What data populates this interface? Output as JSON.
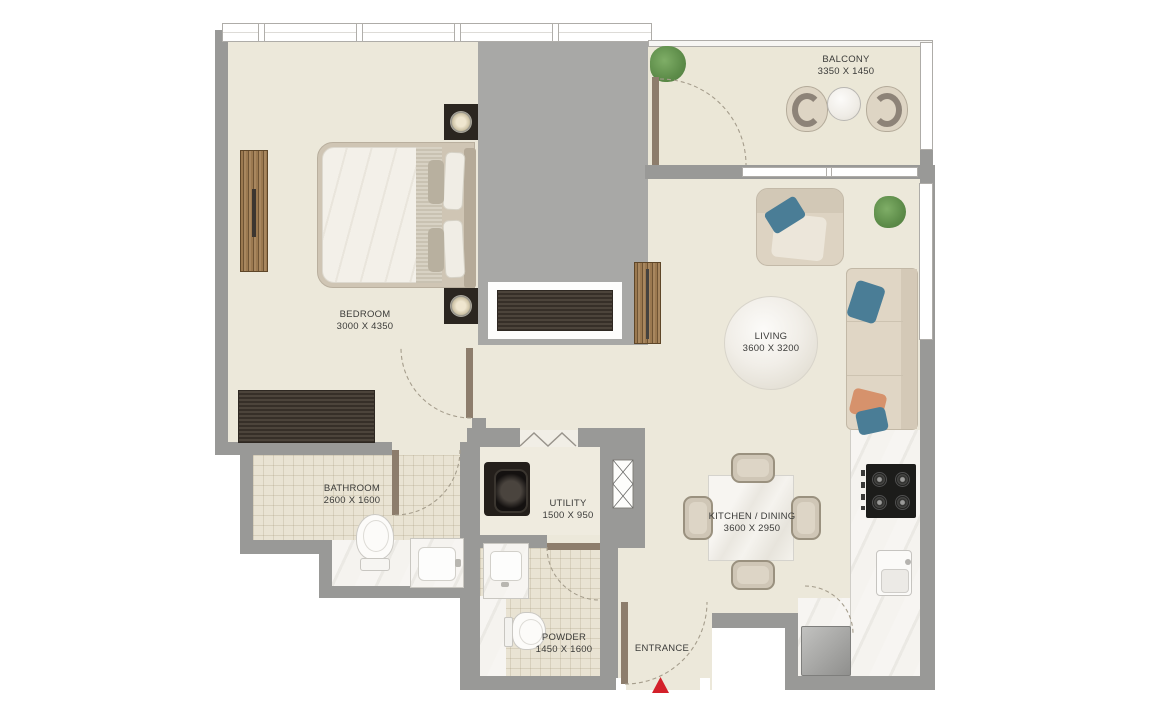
{
  "rooms": {
    "bedroom": {
      "label": "BEDROOM",
      "dims": "3000 X 4350"
    },
    "balcony": {
      "label": "BALCONY",
      "dims": "3350 X 1450"
    },
    "living": {
      "label": "LIVING",
      "dims": "3600 X 3200"
    },
    "bathroom": {
      "label": "BATHROOM",
      "dims": "2600 X 1600"
    },
    "utility": {
      "label": "UTILITY",
      "dims": "1500 X 950"
    },
    "kitchen_dining": {
      "label": "KITCHEN / DINING",
      "dims": "3600 X 2950"
    },
    "powder": {
      "label": "POWDER",
      "dims": "1450 X 1600"
    },
    "entrance": {
      "label": "ENTRANCE"
    }
  },
  "colors": {
    "wall": "#999997",
    "service_core": "#a8a8a6",
    "floor_cream": "#ece8da",
    "tile": "#e9e3d3",
    "marble": "#f4f2ee",
    "wood": "#8a6b47",
    "wardrobe_dark": "#453d34",
    "entrance_marker_red": "#d3202a",
    "pillow_blue": "#4a7d96",
    "pillow_orange": "#d6926c",
    "plant_green": "#5d8c49"
  }
}
